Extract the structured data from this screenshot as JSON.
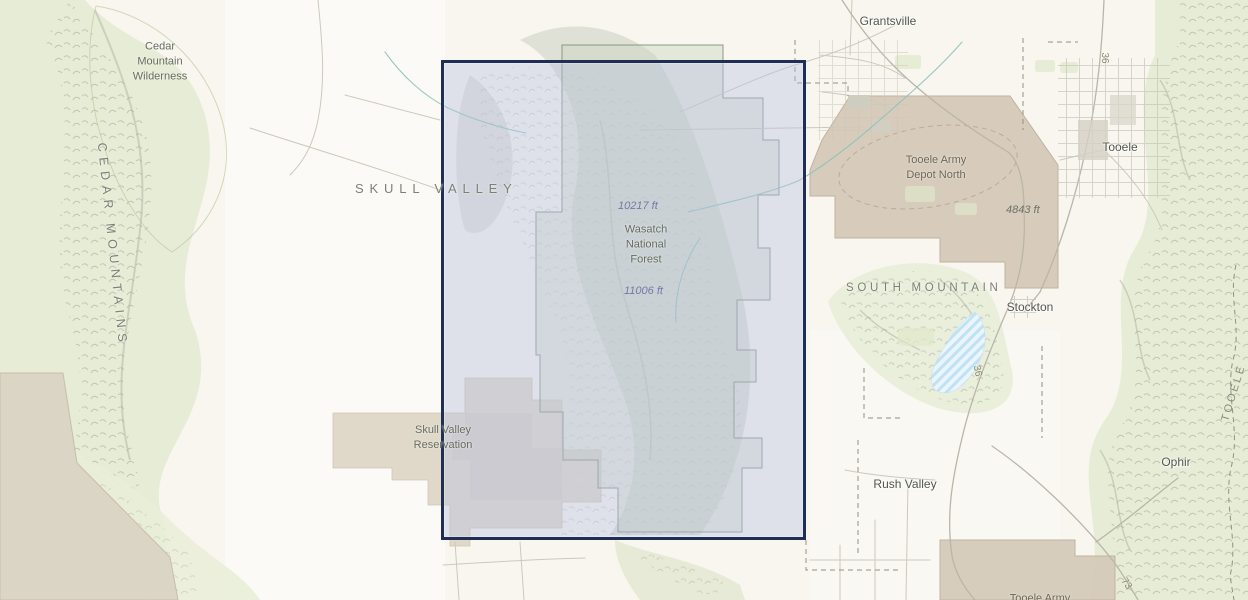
{
  "map": {
    "selection": {
      "border_color": "#1f2e55",
      "fill_color": "#bbc0e3"
    },
    "labels": {
      "cedar_mountain_wilderness": "Cedar\nMountain\nWilderness",
      "cedar_mountains": "CEDAR MOUNTAINS",
      "skull_valley": "SKULL VALLEY",
      "grantsville": "Grantsville",
      "tooele_army_depot_north": "Tooele Army\nDepot North",
      "tooele": "Tooele",
      "elevation_4843": "4843 ft",
      "elevation_10217": "10217 ft",
      "wasatch_national_forest": "Wasatch\nNational\nForest",
      "elevation_11006": "11006 ft",
      "south_mountain": "SOUTH MOUNTAIN",
      "stockton": "Stockton",
      "skull_valley_reservation": "Skull Valley\nReservation",
      "rush_valley": "Rush Valley",
      "ophir": "Ophir",
      "tooele_army_south": "Tooele Army",
      "route_36_north": "36",
      "route_36_south": "36",
      "route_73": "73",
      "tooele_county": "TOOELE"
    }
  }
}
